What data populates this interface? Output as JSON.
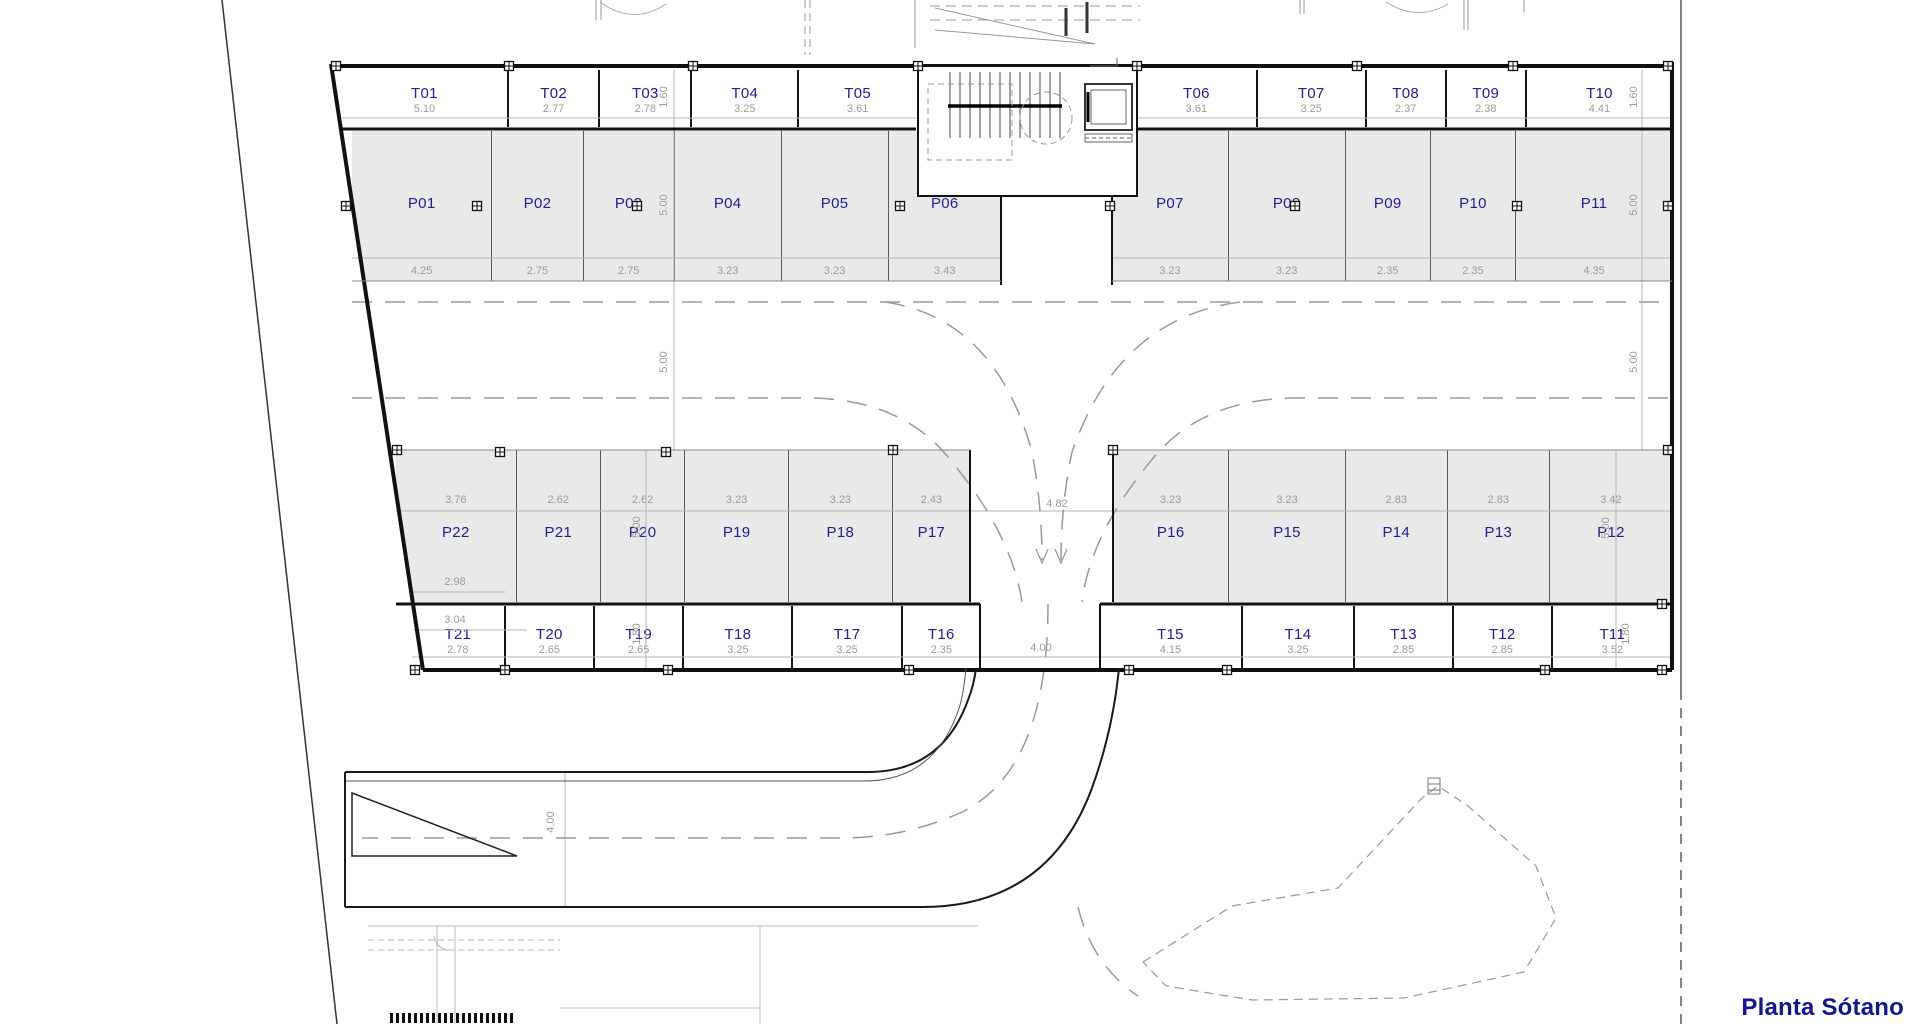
{
  "title": "Planta Sótano",
  "colors": {
    "label_blue": "#20208f",
    "dim_gray": "#9b9b9b",
    "stall_fill": "#e9e9e9",
    "wall": "#111111",
    "title_blue": "#15158c"
  },
  "stalls": {
    "top_storage_left": [
      {
        "id": "T01",
        "dim": "5.10"
      },
      {
        "id": "T02",
        "dim": "2.77"
      },
      {
        "id": "T03",
        "dim": "2.78"
      },
      {
        "id": "T04",
        "dim": "3.25"
      },
      {
        "id": "T05",
        "dim": "3.61"
      }
    ],
    "top_storage_right": [
      {
        "id": "T06",
        "dim": "3.61"
      },
      {
        "id": "T07",
        "dim": "3.25"
      },
      {
        "id": "T08",
        "dim": "2.37"
      },
      {
        "id": "T09",
        "dim": "2.38"
      },
      {
        "id": "T10",
        "dim": "4.41"
      }
    ],
    "top_parking_left": [
      {
        "id": "P01",
        "dim": "4.25"
      },
      {
        "id": "P02",
        "dim": "2.75"
      },
      {
        "id": "P03",
        "dim": "2.75"
      },
      {
        "id": "P04",
        "dim": "3.23"
      },
      {
        "id": "P05",
        "dim": "3.23"
      },
      {
        "id": "P06",
        "dim": "3.43"
      }
    ],
    "top_parking_right": [
      {
        "id": "P07",
        "dim": "3.23"
      },
      {
        "id": "P08",
        "dim": "3.23"
      },
      {
        "id": "P09",
        "dim": "2.35"
      },
      {
        "id": "P10",
        "dim": "2.35"
      },
      {
        "id": "P11",
        "dim": "4.35"
      }
    ],
    "bottom_parking_left": [
      {
        "id": "P22",
        "dim": "3.76"
      },
      {
        "id": "P21",
        "dim": "2.62"
      },
      {
        "id": "P20",
        "dim": "2.62"
      },
      {
        "id": "P19",
        "dim": "3.23"
      },
      {
        "id": "P18",
        "dim": "3.23"
      },
      {
        "id": "P17",
        "dim": "2.43"
      }
    ],
    "bottom_parking_right": [
      {
        "id": "P16",
        "dim": "3.23"
      },
      {
        "id": "P15",
        "dim": "3.23"
      },
      {
        "id": "P14",
        "dim": "2.83"
      },
      {
        "id": "P13",
        "dim": "2.83"
      },
      {
        "id": "P12",
        "dim": "3.42"
      }
    ],
    "bottom_storage_left": [
      {
        "id": "T21",
        "dim": "2.78"
      },
      {
        "id": "T20",
        "dim": "2.65"
      },
      {
        "id": "T19",
        "dim": "2.65"
      },
      {
        "id": "T18",
        "dim": "3.25"
      },
      {
        "id": "T17",
        "dim": "3.25"
      },
      {
        "id": "T16",
        "dim": "2.35"
      }
    ],
    "bottom_storage_right": [
      {
        "id": "T15",
        "dim": "4.15"
      },
      {
        "id": "T14",
        "dim": "3.25"
      },
      {
        "id": "T13",
        "dim": "2.85"
      },
      {
        "id": "T12",
        "dim": "2.85"
      },
      {
        "id": "T11",
        "dim": "3.52"
      }
    ]
  },
  "dims": {
    "d160": "1.60",
    "d500": "5.00",
    "d180": "1.80",
    "d482": "4.82",
    "d400": "4.00",
    "d298": "2.98",
    "d304": "3.04"
  }
}
